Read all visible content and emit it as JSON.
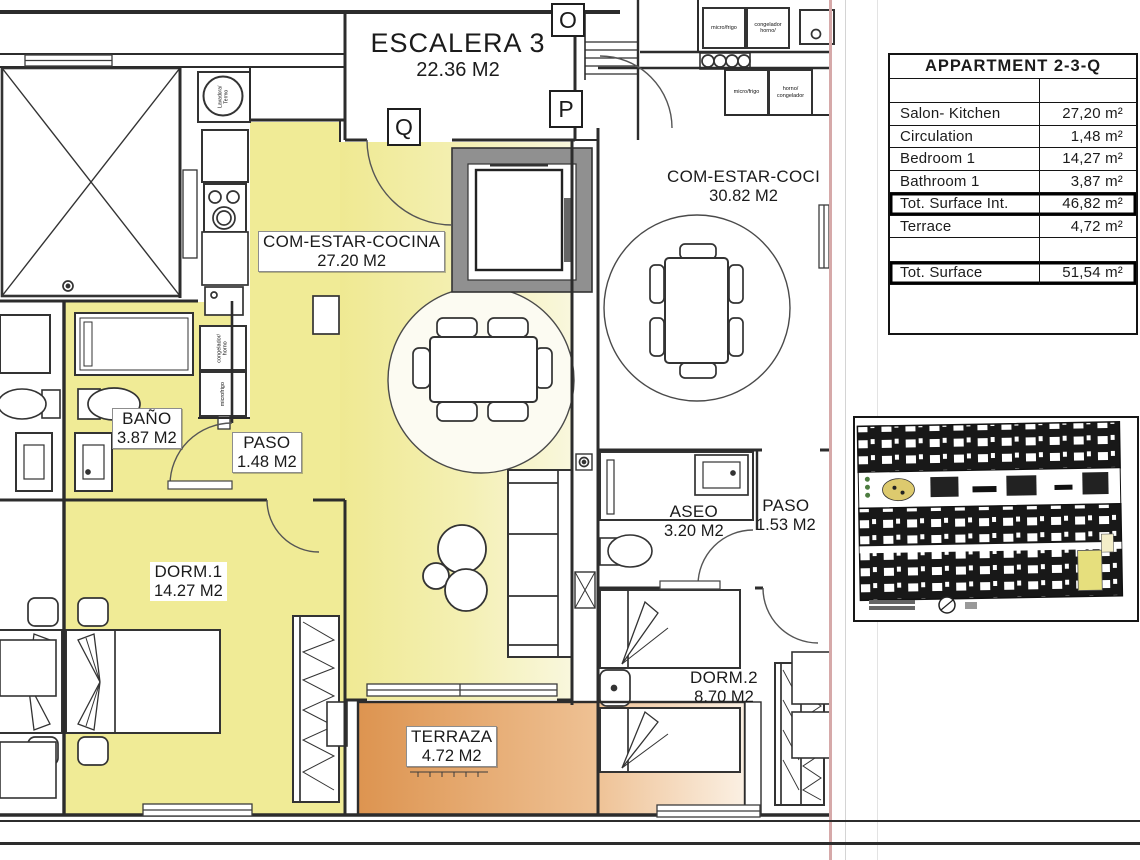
{
  "plan": {
    "escalera": {
      "name": "ESCALERA 3",
      "area": "22.36 M2"
    },
    "letters": {
      "o": "O",
      "p": "P",
      "q": "Q"
    },
    "rooms": {
      "salon": {
        "name": "COM-ESTAR-COCINA",
        "area": "27.20 M2"
      },
      "bano": {
        "name": "BAÑO",
        "area": "3.87 M2"
      },
      "paso1": {
        "name": "PASO",
        "area": "1.48 M2"
      },
      "dorm1": {
        "name": "DORM.1",
        "area": "14.27 M2"
      },
      "terraza": {
        "name": "TERRAZA",
        "area": "4.72 M2"
      },
      "salon2": {
        "name": "COM-ESTAR-COCI",
        "area": "30.82 M2"
      },
      "aseo": {
        "name": "ASEO",
        "area": "3.20 M2"
      },
      "paso2": {
        "name": "PASO",
        "area": "1.53 M2"
      },
      "dorm2": {
        "name": "DORM.2",
        "area": "8.70 M2"
      }
    },
    "appliances": {
      "micro_frigo": "micro/frigo",
      "congelador_horno": "congelador horno/",
      "horno_congelador": "horno/ congelador",
      "congelador_horno_v": "congelador/ horno",
      "microfrigo": "microfrigo",
      "lavadora": "Lavadora/ Termo"
    }
  },
  "summary_table": {
    "title": "APPARTMENT 2-3-Q",
    "rows": [
      {
        "label": "",
        "value": "",
        "cls": "spacer"
      },
      {
        "label": "Salon- Kitchen",
        "value": "27,20 m²",
        "cls": ""
      },
      {
        "label": "Circulation",
        "value": "1,48 m²",
        "cls": ""
      },
      {
        "label": "Bedroom 1",
        "value": "14,27 m²",
        "cls": ""
      },
      {
        "label": "Bathroom 1",
        "value": "3,87 m²",
        "cls": ""
      },
      {
        "label": "Tot. Surface Int.",
        "value": "46,82 m²",
        "cls": "bold-row"
      },
      {
        "label": "Terrace",
        "value": "4,72 m²",
        "cls": ""
      },
      {
        "label": "",
        "value": "",
        "cls": "spacer"
      },
      {
        "label": "Tot. Surface",
        "value": "51,54 m²",
        "cls": "bold-row"
      }
    ]
  },
  "colors": {
    "highlight_yellow": "#f0eb96",
    "terrace_orange": "#e09552",
    "boundary_pink": "#d6a9a9"
  }
}
